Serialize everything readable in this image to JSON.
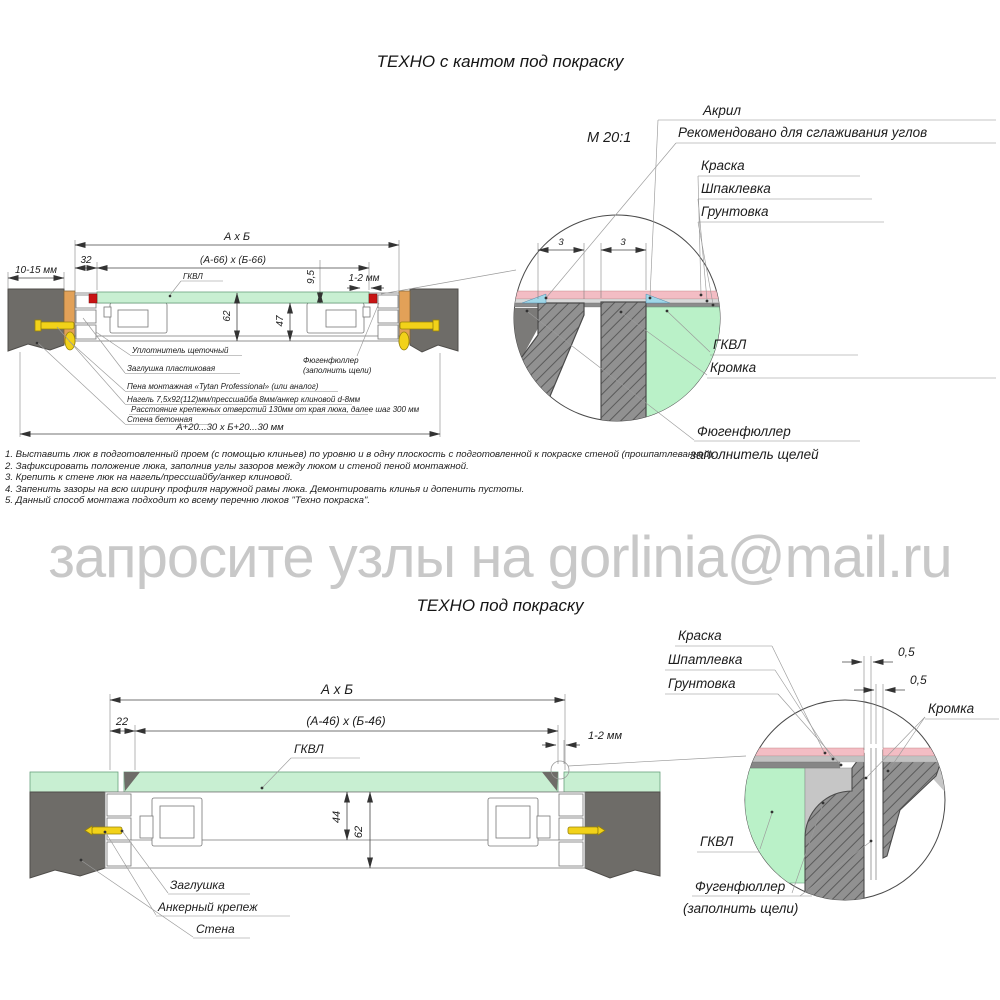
{
  "titles": {
    "top": "ТЕХНО с кантом под покраску",
    "bottom": "ТЕХНО под покраску",
    "watermark": "запросите узлы на gorlinia@mail.ru"
  },
  "scale_label": "М 20:1",
  "top_diagram": {
    "dims": {
      "overall": "А х Б",
      "inner": "(А-66) х (Б-66)",
      "offset": "32",
      "wall_gap": "10-15 мм",
      "panel_thickness": "9,5",
      "edge_gap": "1-2 мм",
      "depth_total": "62",
      "depth_inner": "47",
      "opening": "А+20...30 х Б+20...30 мм"
    },
    "labels": {
      "gkvl": "ГКВЛ",
      "uplotnitel": "Уплотнитель щеточный",
      "zaglushka": "Заглушка пластиковая",
      "pena": "Пена монтажная «Tytan Professional» (или аналог)",
      "nagel": "Нагель 7,5х92(112)мм/прессшайба 8мм/анкер клиновой d-8мм",
      "rasstoyanie": "Расстояние крепежных отверстий 130мм от края люка, далее шаг 300 мм",
      "stena": "Стена бетонная",
      "fugen1": "Фюгенфюллер",
      "fugen2": "(заполнить щели)"
    }
  },
  "top_detail": {
    "dim_left": "3",
    "dim_right": "3",
    "akril": "Акрил",
    "akril_note": "Рекомендовано для сглаживания углов",
    "kraska": "Краска",
    "shpaklevka": "Шпаклевка",
    "gruntovka": "Грунтовка",
    "gkvl": "ГКВЛ",
    "kromka": "Кромка",
    "fugen1": "Фюгенфюллер",
    "fugen2": "заполнитель щелей"
  },
  "notes": [
    "1. Выставить люк в подготовленный проем (с помощью клиньев) по уровню и в одну плоскость с подготовленной к покраске стеной (прошпатлеванной).",
    "2. Зафиксировать положение люка, заполнив углы зазоров между люком и стеной пеной монтажной.",
    "3. Крепить к стене люк на нагель/прессшайбу/анкер клиновой.",
    "4. Запенить зазоры на всю ширину профиля наружной рамы люка. Демонтировать клинья и допенить пустоты.",
    "5. Данный способ монтажа подходит ко всему перечню люков \"Техно покраска\"."
  ],
  "bottom_diagram": {
    "dims": {
      "overall": "А х Б",
      "inner": "(А-46) х (Б-46)",
      "offset": "22",
      "edge_gap": "1-2 мм",
      "depth_inner": "44",
      "depth_total": "62"
    },
    "labels": {
      "gkvl": "ГКВЛ",
      "zaglushka": "Заглушка",
      "anker": "Анкерный крепеж",
      "stena": "Стена"
    }
  },
  "bottom_detail": {
    "kraska": "Краска",
    "shpatlevka": "Шпатлевка",
    "gruntovka": "Грунтовка",
    "kromka": "Кромка",
    "gkvl": "ГКВЛ",
    "fugen1": "Фугенфюллер",
    "fugen2": "(заполнить щели)",
    "half1": "0,5",
    "half2": "0,5"
  },
  "colors": {
    "wall_gray": "#6e6c68",
    "hatch_gray": "#919191",
    "green_panel": "#c8efd2",
    "green_detail": "#baf1c8",
    "paint_pink": "#f3bdc4",
    "acryl_blue": "#9fd7e8",
    "wood_orange": "#e2a158",
    "anchor_yellow": "#f2d219",
    "marker_red": "#c81414",
    "watermark_gray": "#c8c8c8"
  }
}
